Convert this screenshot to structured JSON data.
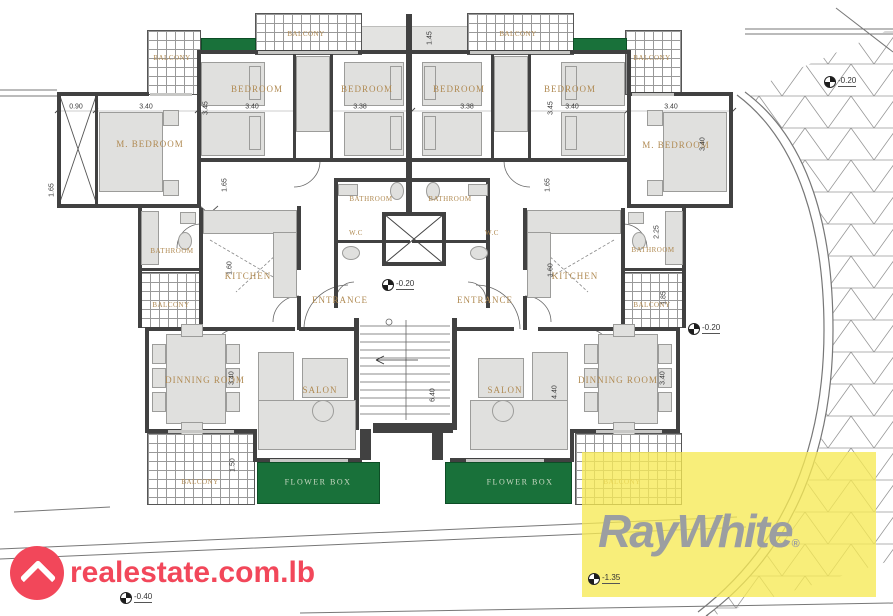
{
  "labels": {
    "m_bedroom_left": "M. BEDROOM",
    "bedroom_1": "BEDROOM",
    "bedroom_2": "BEDROOM",
    "bedroom_3": "BEDROOM",
    "bedroom_4": "BEDROOM",
    "m_bedroom_right": "M. BEDROOM",
    "balcony_top_left": "BALCONY",
    "balcony_top_center_left": "BALCONY",
    "balcony_top_center_right": "BALCONY",
    "balcony_top_right": "BALCONY",
    "bathroom_center_left": "BATHROOM",
    "bathroom_center_right": "BATHROOM",
    "wc_left": "W.C",
    "wc_right": "W.C",
    "entrance_left": "ENTRANCE",
    "entrance_right": "ENTRANCE",
    "kitchen_left": "KITCHEN",
    "kitchen_right": "KITCHEN",
    "bathroom_left": "BATHROOM",
    "bathroom_right": "BATHROOM",
    "balcony_mid_left": "BALCONY",
    "balcony_mid_right": "BALCONY",
    "dining_left": "DINNING ROOM",
    "dining_right": "DINNING ROOM",
    "salon_left": "SALON",
    "salon_right": "SALON",
    "flower_box_left": "FLOWER BOX",
    "flower_box_right": "FLOWER BOX",
    "balcony_bottom_left": "BALCONY",
    "balcony_bottom_right": "BALCONY"
  },
  "dimensions": {
    "v090": "0.90",
    "v340": "3.40",
    "v338": "3.38",
    "v345": "3.45",
    "v145": "1.45",
    "v165": "1.65",
    "v225": "2.25",
    "v185": "1.85",
    "v160": "1.60",
    "v440": "4.40",
    "v640": "6.40",
    "v150": "1.50"
  },
  "levels": {
    "topright": "-0.20",
    "entrance": "-0.20",
    "midright": "-0.20",
    "bottomleft": "-0.40",
    "yellow": "-1.35"
  },
  "branding": {
    "realestate_text": "realestate.com.lb",
    "raywhite_text": "RayWhite",
    "registered_mark": "®"
  },
  "colors": {
    "wall": "#414141",
    "flower_box_green": "#19713a",
    "highlight_yellow": "#f6e955",
    "label_tan": "#b08a52",
    "realestate_pink": "#f2475a",
    "raywhite_gray": "#9b9ea1"
  }
}
